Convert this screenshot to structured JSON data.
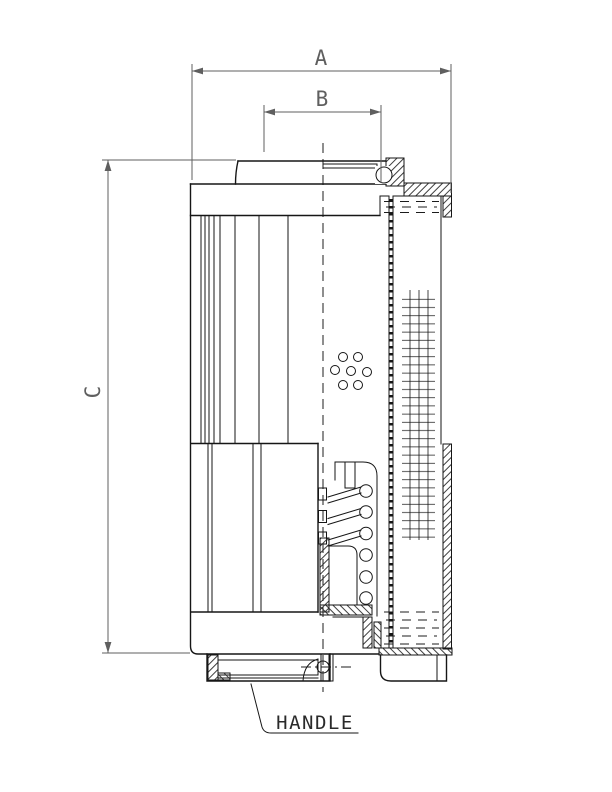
{
  "drawing": {
    "type": "technical-section-drawing",
    "subject": "filter-element-cross-section",
    "labels": {
      "dim_a": "A",
      "dim_b": "B",
      "dim_c": "C",
      "handle_callout": "HANDLE"
    },
    "colors": {
      "ink": "#161616",
      "dimension_ink": "#5f5f5f",
      "background": "#ffffff"
    }
  }
}
